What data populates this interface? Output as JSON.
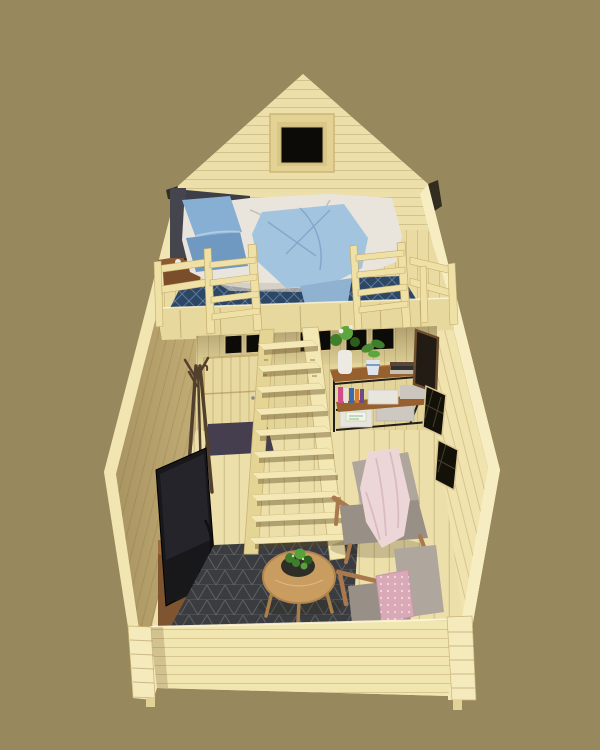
{
  "scene": {
    "alt": "3D cutaway render of a tiny wooden cabin interior with sleeping loft and living area",
    "objects": [
      "gable wall",
      "gable window",
      "sleeping loft",
      "double bed",
      "blue pillows",
      "blue throw blanket",
      "loft rug",
      "loft railing",
      "loft ladders",
      "steep wooden staircase",
      "back door",
      "transom windows",
      "doormat",
      "console shelf with plants and boxes",
      "picture frame",
      "right wall windows",
      "coat rack",
      "television",
      "media bench",
      "living room rug",
      "round coffee table",
      "plant bowl",
      "two armchairs",
      "pink blanket",
      "pink polka-dot pillow",
      "low front wall with corner posts"
    ]
  },
  "colors": {
    "bg": "#97895D",
    "silhouette": "#F3E8B8",
    "gable": "#ECDFA9",
    "windowFrame": "#E3D294",
    "windowTrim": "#D9C788",
    "windowDark": "#0D0B07",
    "leftWallBase": "#C3AE77",
    "leftWallOuter": "#F1E5B2",
    "rightWall": "#F0E3AE",
    "rightWallOuter": "#F7EDC2",
    "floor": "#ECDFAA",
    "loftFloor": "#E9DBA2",
    "loftRug": "#2C4765",
    "beam": "#E7D89E",
    "rail": "#EFE1A6",
    "stair": "#F3E7B4",
    "stairSide": "#E4D595",
    "underLoftWall": "#E3D49A",
    "door": "#E8D9A1",
    "doormat": "#453E4F",
    "headboard": "#45454E",
    "duvet": "#E9E5DD",
    "duvetShade": "#CEC8BD",
    "pillowBlue": "#87AFD3",
    "pillowBlue2": "#7099C1",
    "throwBlue": "#A3C4DF",
    "throwTail": "#8FB2D0",
    "nightstand": "#8A5A33",
    "shelfWood": "#96602F",
    "shelfFrame": "#231E18",
    "vase": "#EDEAE3",
    "plantGreen": "#3F7E2C",
    "plantGreenLight": "#5CA63D",
    "plantGreenDark": "#2B5D1D",
    "potWhite": "#DFE5EB",
    "bookPink": "#CE4E8C",
    "bookBlue": "#3E68B0",
    "bookOrange": "#D97A2E",
    "bookPurple": "#6B4A8A",
    "boxWhite": "#E8E5DC",
    "boxGray": "#CBC7BF",
    "frameBrown": "#6E4E30",
    "frameInner": "#221C14",
    "coatRack": "#53402C",
    "tv": "#18181B",
    "benchWood": "#9A6B3E",
    "benchFront": "#7E5530",
    "benchPanel": "#E9E5DB",
    "livingRug": "#3A3C3F",
    "tableWood": "#C99C5F",
    "tableLeg": "#A97F49",
    "bowl": "#2E2D28",
    "chairFabric": "#AFA69D",
    "chairFabricDark": "#988F86",
    "chairWood": "#A9794D",
    "blanketPink": "#EDD6D8",
    "blanketShade": "#D9BBC0",
    "pillowPink": "#D9A9B7",
    "frontWall": "#F2E6B0",
    "post": "#F5EABB",
    "eaveDark": "#332D20"
  }
}
